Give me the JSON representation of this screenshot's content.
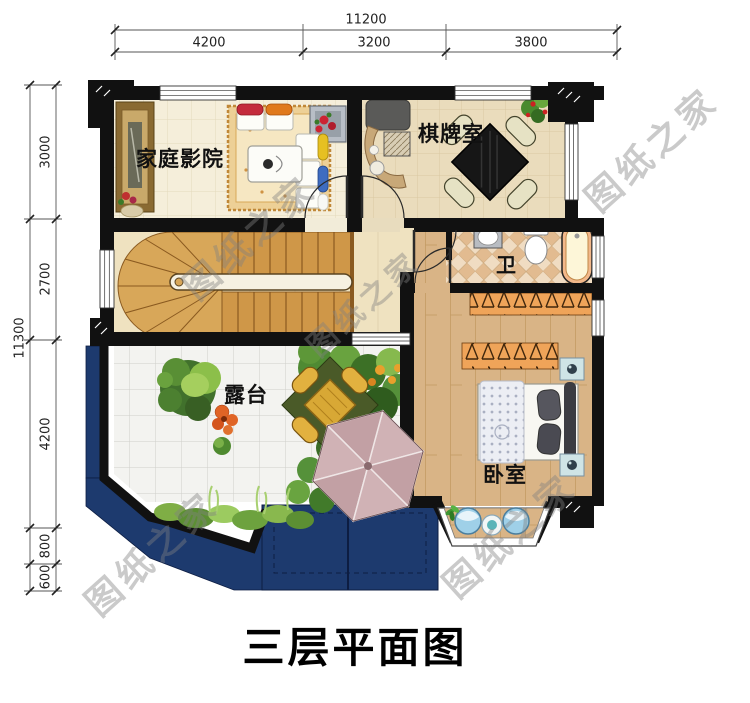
{
  "title": "三层平面图",
  "watermark": "图纸之家",
  "dimensions": {
    "top": {
      "total": "11200",
      "segments": [
        "4200",
        "3200",
        "3800"
      ]
    },
    "left": {
      "total": "11300",
      "segments": [
        "3000",
        "2700",
        "4200",
        "800",
        "600"
      ]
    }
  },
  "rooms": {
    "home_theater": "家庭影院",
    "chess_room": "棋牌室",
    "bathroom": "卫",
    "terrace": "露台",
    "bedroom": "卧室"
  },
  "colors": {
    "wall": "#111111",
    "roof_navy": "#1d3a6e",
    "stair_wood": "#d09a4b",
    "floor_wood": "#d9b486",
    "umbrella": "#cdafb2"
  }
}
